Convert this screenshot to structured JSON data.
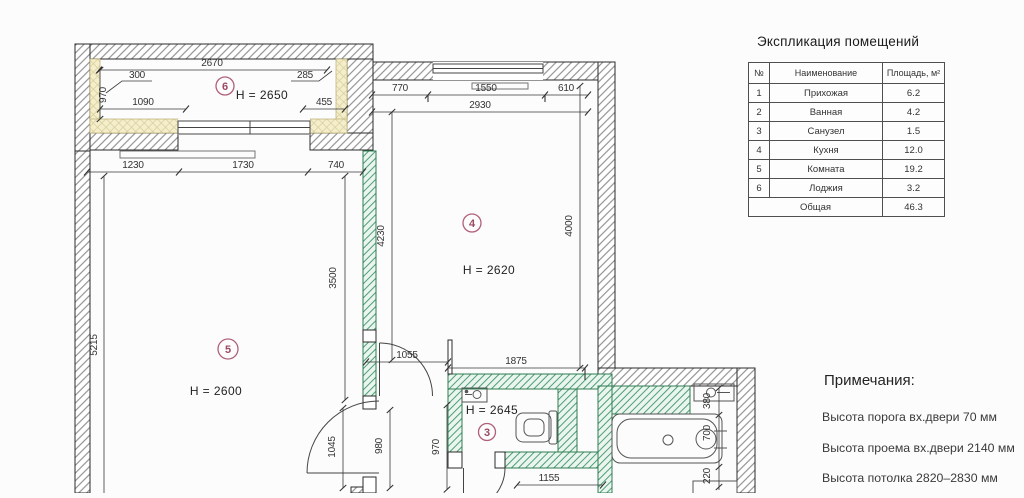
{
  "plan": {
    "rooms": {
      "loggia": {
        "number": "6",
        "height": "H = 2650"
      },
      "living": {
        "number": "5",
        "height": "H = 2600"
      },
      "kitchen": {
        "number": "4",
        "height": "H = 2620"
      },
      "wc": {
        "number": "3",
        "height": "H = 2645"
      }
    },
    "dims": {
      "loggia_width": "2670",
      "loggia_jamb_left": "300",
      "loggia_jamb_right": "285",
      "loggia_depth": "970",
      "loggia_1090": "1090",
      "loggia_455": "455",
      "row_1230": "1230",
      "row_1730": "1730",
      "row_740": "740",
      "living_height": "5215",
      "living_3500": "3500",
      "kit_770": "770",
      "kit_1550": "1550",
      "kit_610": "610",
      "kit_2930": "2930",
      "kit_4230": "4230",
      "kit_4000": "4000",
      "door_1055": "1055",
      "wc_1875": "1875",
      "hall_1045": "1045",
      "hall_980": "980",
      "hall_970": "970",
      "wc_1155": "1155",
      "bath_380": "380",
      "bath_700": "700",
      "bath_220": "220"
    }
  },
  "explication": {
    "title": "Экспликация помещений",
    "headers": {
      "num": "№",
      "name": "Наименование",
      "area": "Площадь, м²"
    },
    "rows": [
      {
        "num": "1",
        "name": "Прихожая",
        "area": "6.2"
      },
      {
        "num": "2",
        "name": "Ванная",
        "area": "4.2"
      },
      {
        "num": "3",
        "name": "Санузел",
        "area": "1.5"
      },
      {
        "num": "4",
        "name": "Кухня",
        "area": "12.0"
      },
      {
        "num": "5",
        "name": "Комната",
        "area": "19.2"
      },
      {
        "num": "6",
        "name": "Лоджия",
        "area": "3.2"
      }
    ],
    "total": {
      "label": "Общая",
      "area": "46.3"
    }
  },
  "notes": {
    "title": "Примечания:",
    "items": [
      "Высота порога вх.двери 70 мм",
      "Высота проема вх.двери 2140 мм",
      "Высота потолка 2820–2830 мм"
    ]
  },
  "colors": {
    "partition_green": "#4f9e74",
    "insulation_yellow": "#f4eecb",
    "room_mark": "#a85a70"
  }
}
